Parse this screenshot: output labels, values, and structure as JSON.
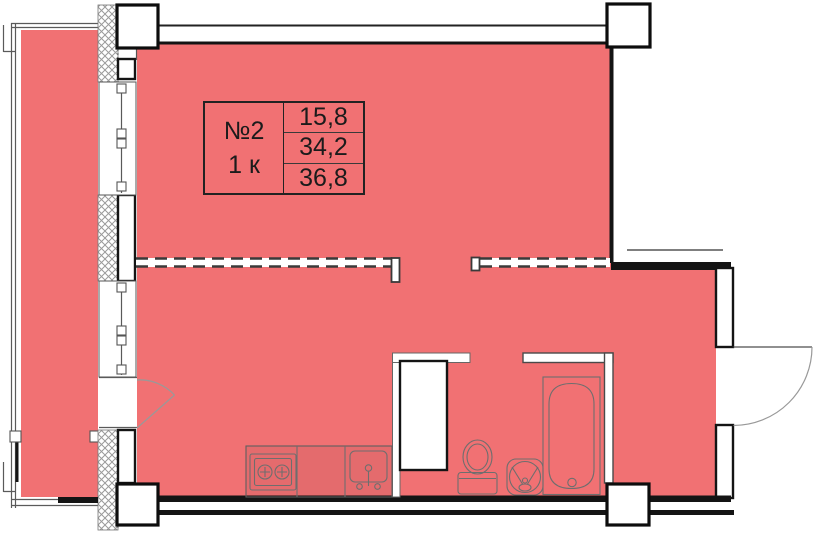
{
  "label_card": {
    "number": "№2",
    "rooms": "1 к",
    "values": [
      "15,8",
      "34,2",
      "36,8"
    ]
  },
  "fixtures": [
    "stove",
    "kitchen-sink",
    "toilet",
    "washbasin",
    "bathtub",
    "ventilation-shaft"
  ],
  "colors": {
    "area-fill": "#F17173",
    "wall": "#141414",
    "fixture-line": "#6E6E6E",
    "text-color": "#1B1B1B"
  }
}
